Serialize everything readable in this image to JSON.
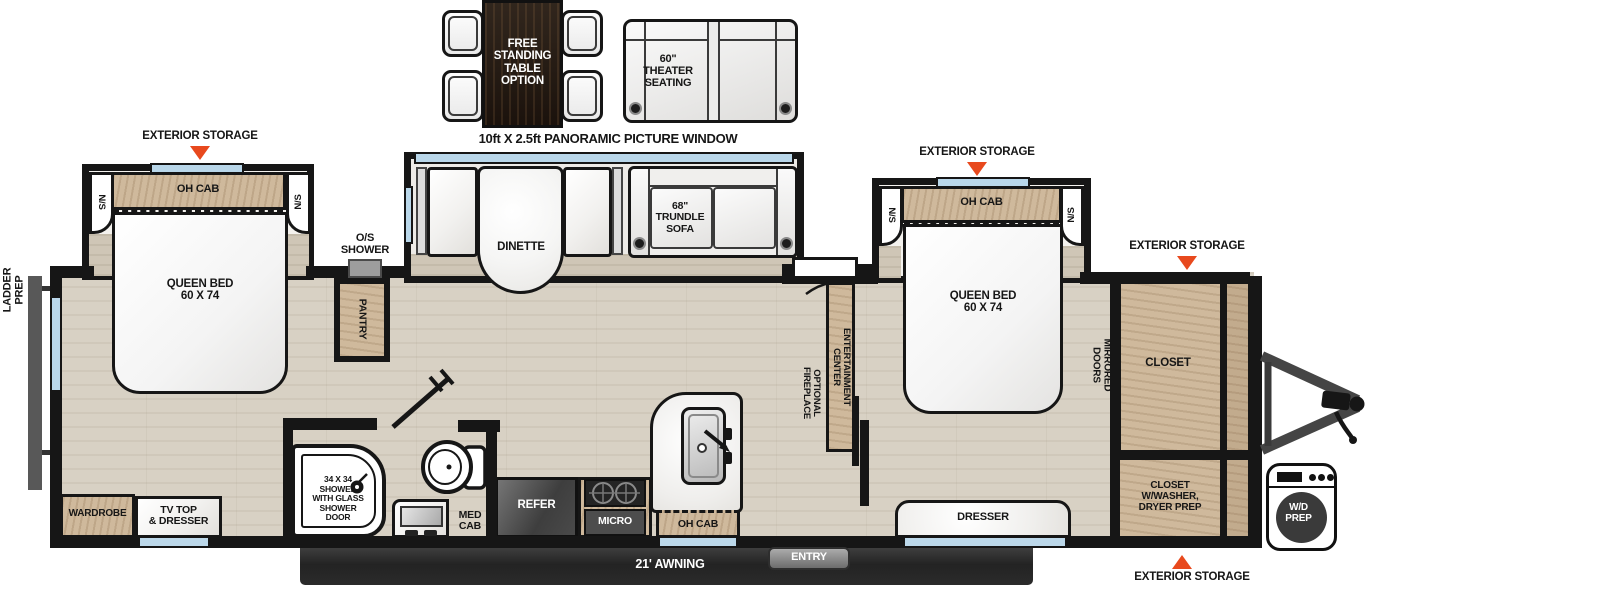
{
  "colors": {
    "accent_red": "#e8491d",
    "wall_black": "#161616",
    "cabinet_wood": "#cfb99c",
    "floor_wood": "#d8d1c4",
    "awning_dark": "#2b2b2b",
    "window_blue": "#b9d7ea",
    "appliance_gray": "#4a4a4a"
  },
  "header": {
    "table_option": "FREE\nSTANDING\nTABLE\nOPTION",
    "theater_seating": "60\"\nTHEATER\nSEATING",
    "window_note": "10ft X 2.5ft PANORAMIC PICTURE WINDOW"
  },
  "shared": {
    "exterior_storage": "EXTERIOR STORAGE",
    "oh_cab": "OH CAB",
    "ns": "N/S",
    "queen_bed": "QUEEN BED\n60 X 74"
  },
  "exterior": {
    "ladder_prep": "LADDER\nPREP",
    "os_shower": "O/S\nSHOWER",
    "awning": "21' AWNING",
    "entry": "ENTRY",
    "wd_prep": "W/D\nPREP"
  },
  "rear_bedroom": {
    "wardrobe": "WARDROBE",
    "tv_dresser": "TV TOP\n& DRESSER"
  },
  "living": {
    "dinette": "DINETTE",
    "trundle_sofa": "68\"\nTRUNDLE\nSOFA",
    "pantry": "PANTRY",
    "entertainment_center": "ENTERTAINMENT CENTER",
    "optional_fireplace": "OPTIONAL\nFIREPLACE"
  },
  "kitchen": {
    "refer": "REFER",
    "micro": "MICRO"
  },
  "bathroom": {
    "shower": "34 X 34\nSHOWER\nWITH GLASS\nSHOWER\nDOOR",
    "med_cab": "MED\nCAB"
  },
  "front_bedroom": {
    "mirrored_doors": "MIRRORED DOORS",
    "closet": "CLOSET",
    "closet_washer": "CLOSET\nW/WASHER,\nDRYER PREP",
    "dresser": "DRESSER"
  }
}
